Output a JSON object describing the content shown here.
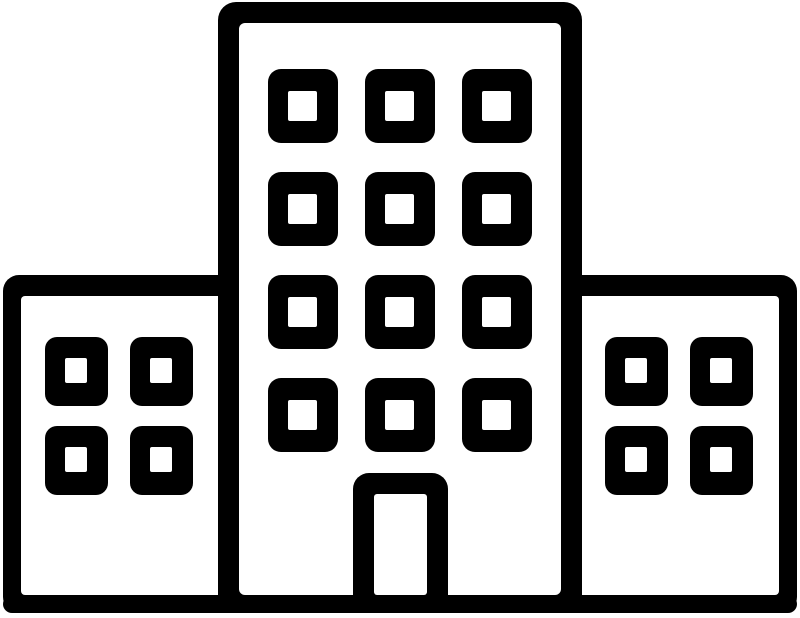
{
  "icon": {
    "name": "office-building-icon",
    "description": "Black outline icon of a building complex: tall central tower with twelve windows and a door, flanked by two shorter wings with four windows each, standing on a common ground line.",
    "colors": {
      "stroke": "#000000",
      "background": "#ffffff"
    },
    "central_building": {
      "window_columns": 3,
      "window_rows": 4,
      "window_count": 12,
      "has_door": true
    },
    "left_building": {
      "window_columns": 2,
      "window_rows": 2,
      "window_count": 4
    },
    "right_building": {
      "window_columns": 2,
      "window_rows": 2,
      "window_count": 4
    },
    "ground_line": true
  }
}
